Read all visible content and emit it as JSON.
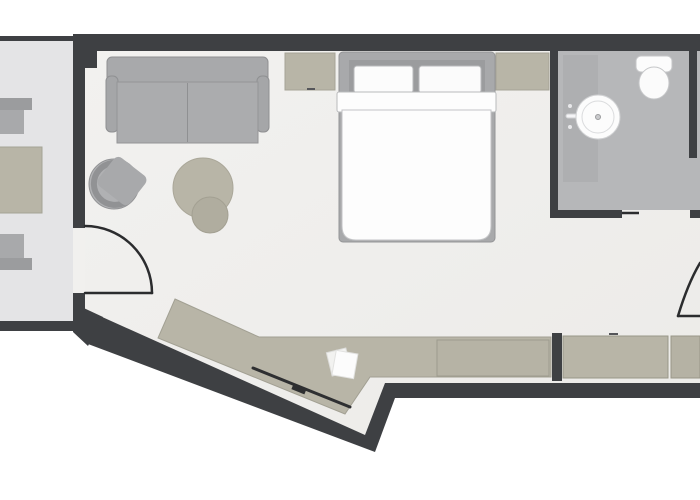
{
  "plan": {
    "type": "hotel-room-floor-plan",
    "rooms": [
      "balcony",
      "living-sleeping-area",
      "bathroom",
      "entry-corridor"
    ],
    "furniture": [
      "outdoor-table",
      "outdoor-chair-top",
      "outdoor-chair-bottom",
      "sofa",
      "armchair",
      "ottoman",
      "nightstand-left",
      "nightstand-right",
      "double-bed",
      "vanity",
      "sink",
      "toilet",
      "desk-console",
      "tv",
      "papers",
      "drawer-unit",
      "wardrobe-left",
      "wardrobe-right"
    ],
    "doors": [
      "balcony-door-swing",
      "bathroom-sliding-door",
      "entry-door-swing"
    ]
  },
  "colors": {
    "wall": "#3e4043",
    "floor": "#f1f0ee",
    "floor_shade": "#eceae7",
    "balcony_floor": "#e4e4e6",
    "bath_floor": "#b6b7b9",
    "vanity": "#aeafb1",
    "gray": "#a8a9ab",
    "gray_dark": "#9b9c9e",
    "gray_light": "#b0b1b3",
    "beige": "#b8b5a7",
    "beige_dark": "#b0ad9f",
    "white_item": "#fcfcfc",
    "duvet": "#fdfdfd",
    "dark_line": "#2b2c2e",
    "tv": "#2e2f31",
    "page_bg": "#ffffff"
  }
}
